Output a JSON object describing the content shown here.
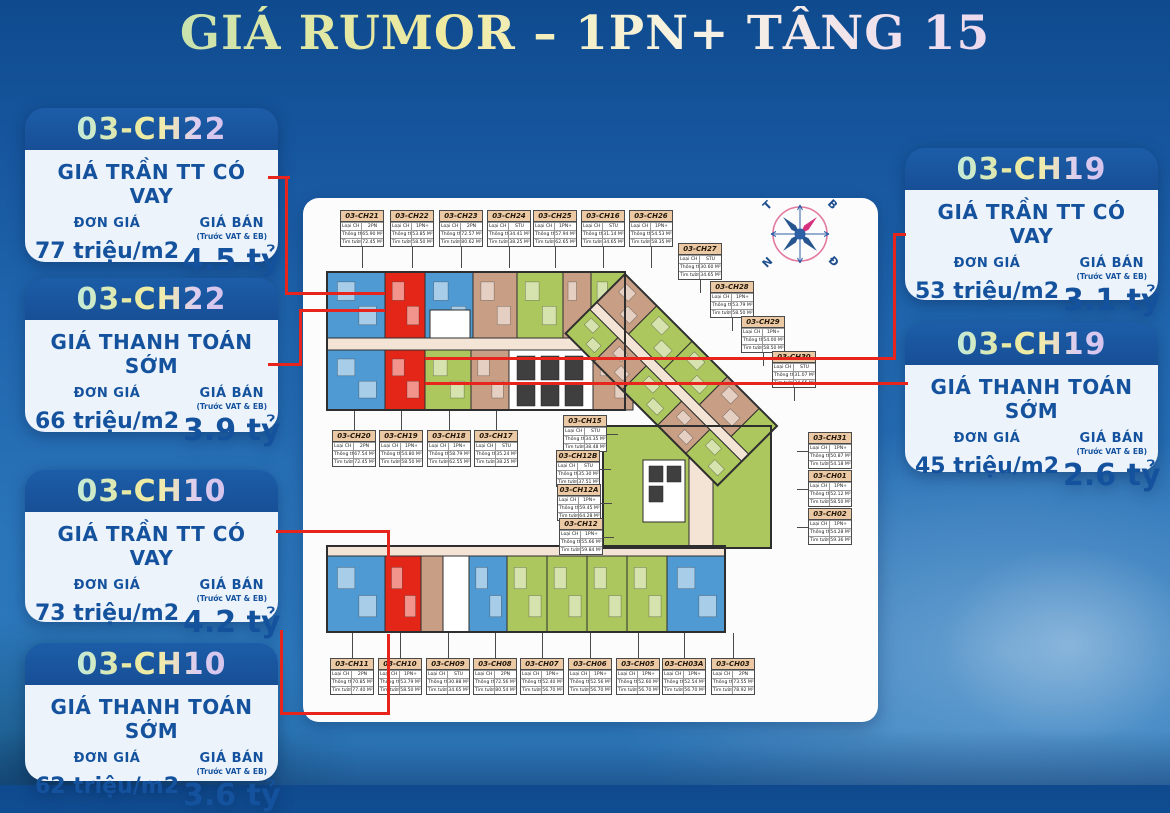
{
  "title": "GIÁ RUMOR – 1PN+ TẦNG 15",
  "cards": [
    {
      "unit": "03-CH22",
      "price_type": "GIÁ TRẦN TT CÓ VAY",
      "unit_price_label": "ĐƠN GIÁ",
      "unit_price": "77 triệu/m2",
      "sale_price_label": "GIÁ BÁN",
      "sale_price_note": "(Trước VAT & EB)",
      "sale_price": "4.5 tỷ"
    },
    {
      "unit": "03-CH22",
      "price_type": "GIÁ THANH TOÁN SỚM",
      "unit_price_label": "ĐƠN GIÁ",
      "unit_price": "66 triệu/m2",
      "sale_price_label": "GIÁ BÁN",
      "sale_price_note": "(Trước VAT & EB)",
      "sale_price": "3.9 tỷ"
    },
    {
      "unit": "03-CH10",
      "price_type": "GIÁ TRẦN TT CÓ VAY",
      "unit_price_label": "ĐƠN GIÁ",
      "unit_price": "73 triệu/m2",
      "sale_price_label": "GIÁ BÁN",
      "sale_price_note": "(Trước VAT & EB)",
      "sale_price": "4.2 tỷ"
    },
    {
      "unit": "03-CH10",
      "price_type": "GIÁ THANH TOÁN SỚM",
      "unit_price_label": "ĐƠN GIÁ",
      "unit_price": "62 triệu/m2",
      "sale_price_label": "GIÁ BÁN",
      "sale_price_note": "(Trước VAT & EB)",
      "sale_price": "3.6 tỷ"
    },
    {
      "unit": "03-CH19",
      "price_type": "GIÁ TRẦN TT CÓ VAY",
      "unit_price_label": "ĐƠN GIÁ",
      "unit_price": "53 triệu/m2",
      "sale_price_label": "GIÁ BÁN",
      "sale_price_note": "(Trước VAT & EB)",
      "sale_price": "3.1 tỷ"
    },
    {
      "unit": "03-CH19",
      "price_type": "GIÁ THANH TOÁN SỚM",
      "unit_price_label": "ĐƠN GIÁ",
      "unit_price": "45 triệu/m2",
      "sale_price_label": "GIÁ BÁN",
      "sale_price_note": "(Trước VAT & EB)",
      "sale_price": "2.6 tỷ"
    }
  ],
  "floorplan": {
    "row_labels": {
      "type": "Loại CH",
      "net": "Thông thủy",
      "gross": "Tim tường"
    },
    "units": [
      {
        "id": "03-CH21",
        "type": "2PN",
        "net": "65.90 M²",
        "gross": "72.45 M²"
      },
      {
        "id": "03-CH22",
        "type": "1PN+",
        "net": "53.85 M²",
        "gross": "58.50 M²"
      },
      {
        "id": "03-CH23",
        "type": "2PN",
        "net": "72.57 M²",
        "gross": "80.62 M²"
      },
      {
        "id": "03-CH24",
        "type": "STU",
        "net": "34.41 M²",
        "gross": "38.25 M²"
      },
      {
        "id": "03-CH25",
        "type": "1PN+",
        "net": "57.94 M²",
        "gross": "62.65 M²"
      },
      {
        "id": "03-CH16",
        "type": "STU",
        "net": "31.14 M²",
        "gross": "34.65 M²"
      },
      {
        "id": "03-CH26",
        "type": "1PN+",
        "net": "54.53 M²",
        "gross": "58.35 M²"
      },
      {
        "id": "03-CH27",
        "type": "STU",
        "net": "30.60 M²",
        "gross": "34.65 M²"
      },
      {
        "id": "03-CH28",
        "type": "1PN+",
        "net": "53.79 M²",
        "gross": "58.50 M²"
      },
      {
        "id": "03-CH29",
        "type": "1PN+",
        "net": "54.00 M²",
        "gross": "58.50 M²"
      },
      {
        "id": "03-CH30",
        "type": "STU",
        "net": "31.07 M²",
        "gross": "34.65 M²"
      },
      {
        "id": "03-CH20",
        "type": "2PN",
        "net": "67.54 M²",
        "gross": "72.45 M²"
      },
      {
        "id": "03-CH19",
        "type": "1PN+",
        "net": "54.80 M²",
        "gross": "58.50 M²"
      },
      {
        "id": "03-CH18",
        "type": "1PN+",
        "net": "58.79 M²",
        "gross": "62.55 M²"
      },
      {
        "id": "03-CH17",
        "type": "STU",
        "net": "35.24 M²",
        "gross": "38.25 M²"
      },
      {
        "id": "03-CH15",
        "type": "STU",
        "net": "34.35 M²",
        "gross": "38.48 M²"
      },
      {
        "id": "03-CH12B",
        "type": "STU",
        "net": "35.30 M²",
        "gross": "37.51 M²"
      },
      {
        "id": "03-CH12A",
        "type": "1PN+",
        "net": "59.45 M²",
        "gross": "64.28 M²"
      },
      {
        "id": "03-CH12",
        "type": "1PN+",
        "net": "55.66 M²",
        "gross": "59.84 M²"
      },
      {
        "id": "03-CH31",
        "type": "1PN+",
        "net": "50.87 M²",
        "gross": "54.18 M²"
      },
      {
        "id": "03-CH01",
        "type": "1PN+",
        "net": "52.12 M²",
        "gross": "58.50 M²"
      },
      {
        "id": "03-CH02",
        "type": "1PN+",
        "net": "54.28 M²",
        "gross": "59.36 M²"
      },
      {
        "id": "03-CH11",
        "type": "2PN",
        "net": "70.85 M²",
        "gross": "77.40 M²"
      },
      {
        "id": "03-CH10",
        "type": "1PN+",
        "net": "53.79 M²",
        "gross": "58.50 M²"
      },
      {
        "id": "03-CH09",
        "type": "STU",
        "net": "30.88 M²",
        "gross": "34.65 M²"
      },
      {
        "id": "03-CH08",
        "type": "2PN",
        "net": "72.56 M²",
        "gross": "80.54 M²"
      },
      {
        "id": "03-CH07",
        "type": "1PN+",
        "net": "52.40 M²",
        "gross": "56.70 M²"
      },
      {
        "id": "03-CH06",
        "type": "1PN+",
        "net": "52.56 M²",
        "gross": "56.70 M²"
      },
      {
        "id": "03-CH05",
        "type": "1PN+",
        "net": "52.60 M²",
        "gross": "56.70 M²"
      },
      {
        "id": "03-CH03A",
        "type": "1PN+",
        "net": "52.54 M²",
        "gross": "56.70 M²"
      },
      {
        "id": "03-CH03",
        "type": "2PN",
        "net": "73.55 M²",
        "gross": "78.92 M²"
      }
    ]
  },
  "compass": {
    "t": "T",
    "b": "B",
    "n": "N",
    "d": "Đ"
  },
  "colors": {
    "highlight": "#e42619",
    "connector": "#e8251c",
    "blue": "#4f9ad3",
    "green": "#acc75d",
    "tan": "#c89e84",
    "corridor": "#f4e4d6",
    "white": "#ffffff",
    "core": "#3f3f3f",
    "outline": "#2e2e2e",
    "card_blue": "#15529e"
  }
}
